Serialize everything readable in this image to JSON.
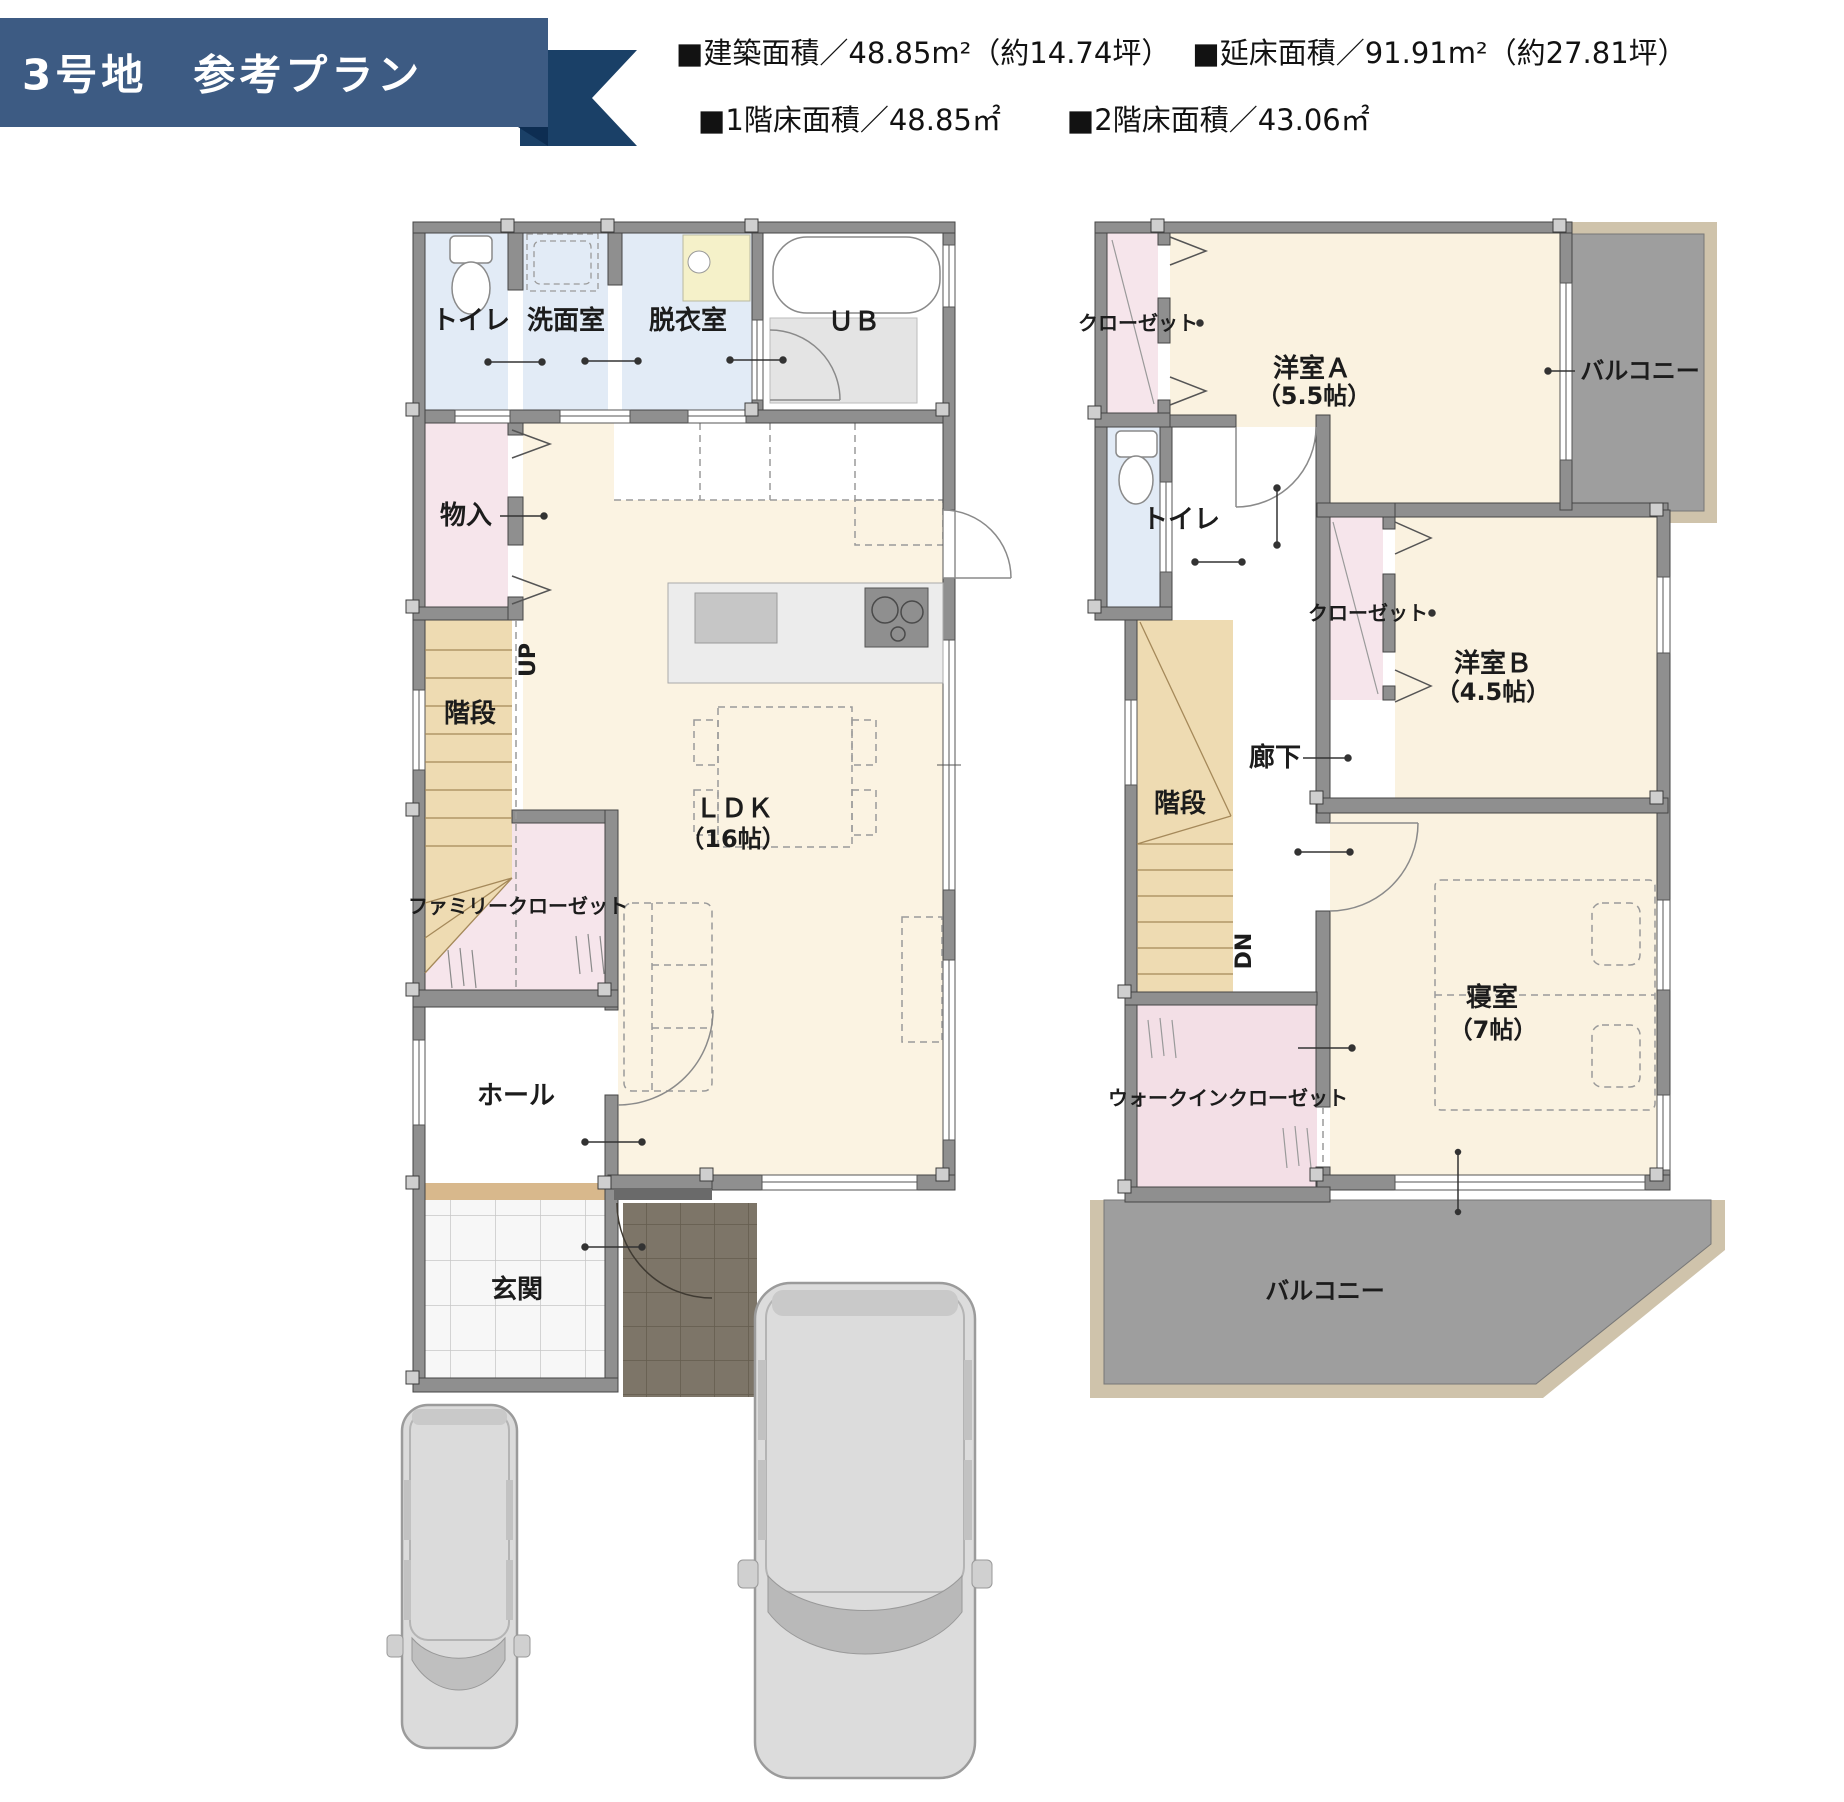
{
  "header": {
    "title": "3号地　参考プラン"
  },
  "specs": {
    "building_area": "■建築面積／48.85m²（約14.74坪）",
    "total_floor_area": "■延床面積／91.91m²（約27.81坪）",
    "floor1_area": "■1階床面積／48.85㎡",
    "floor2_area": "■2階床面積／43.06㎡"
  },
  "floor1": {
    "toilet": "トイレ",
    "washroom": "洗面室",
    "dressing": "脱衣室",
    "bath": "ＵＢ",
    "storage": "物入",
    "stairs": "階段",
    "up": "UP",
    "family_closet": "ファミリークローゼット",
    "ldk": "ＬＤＫ",
    "ldk_size": "（16帖）",
    "hall": "ホール",
    "entrance": "玄関"
  },
  "floor2": {
    "closet_a": "クローゼット",
    "room_a": "洋室Ａ",
    "room_a_size": "（5.5帖）",
    "balcony_top": "バルコニー",
    "toilet": "トイレ",
    "closet_b": "クローゼット",
    "room_b": "洋室Ｂ",
    "room_b_size": "（4.5帖）",
    "corridor": "廊下",
    "stairs": "階段",
    "dn": "DN",
    "wic": "ウォークインクローゼット",
    "bedroom": "寝室",
    "bedroom_size": "（7帖）",
    "balcony_bottom": "バルコニー"
  },
  "colors": {
    "banner": "#3d5b83",
    "banner_dark": "#1a4067",
    "wall": "#8f8f8f",
    "ldk_floor": "#fbf3e2",
    "wet_floor": "#e2ebf6",
    "closet_floor": "#f6e5eb",
    "stairs_floor": "#eedbb2",
    "balcony": "#9e9e9e"
  }
}
